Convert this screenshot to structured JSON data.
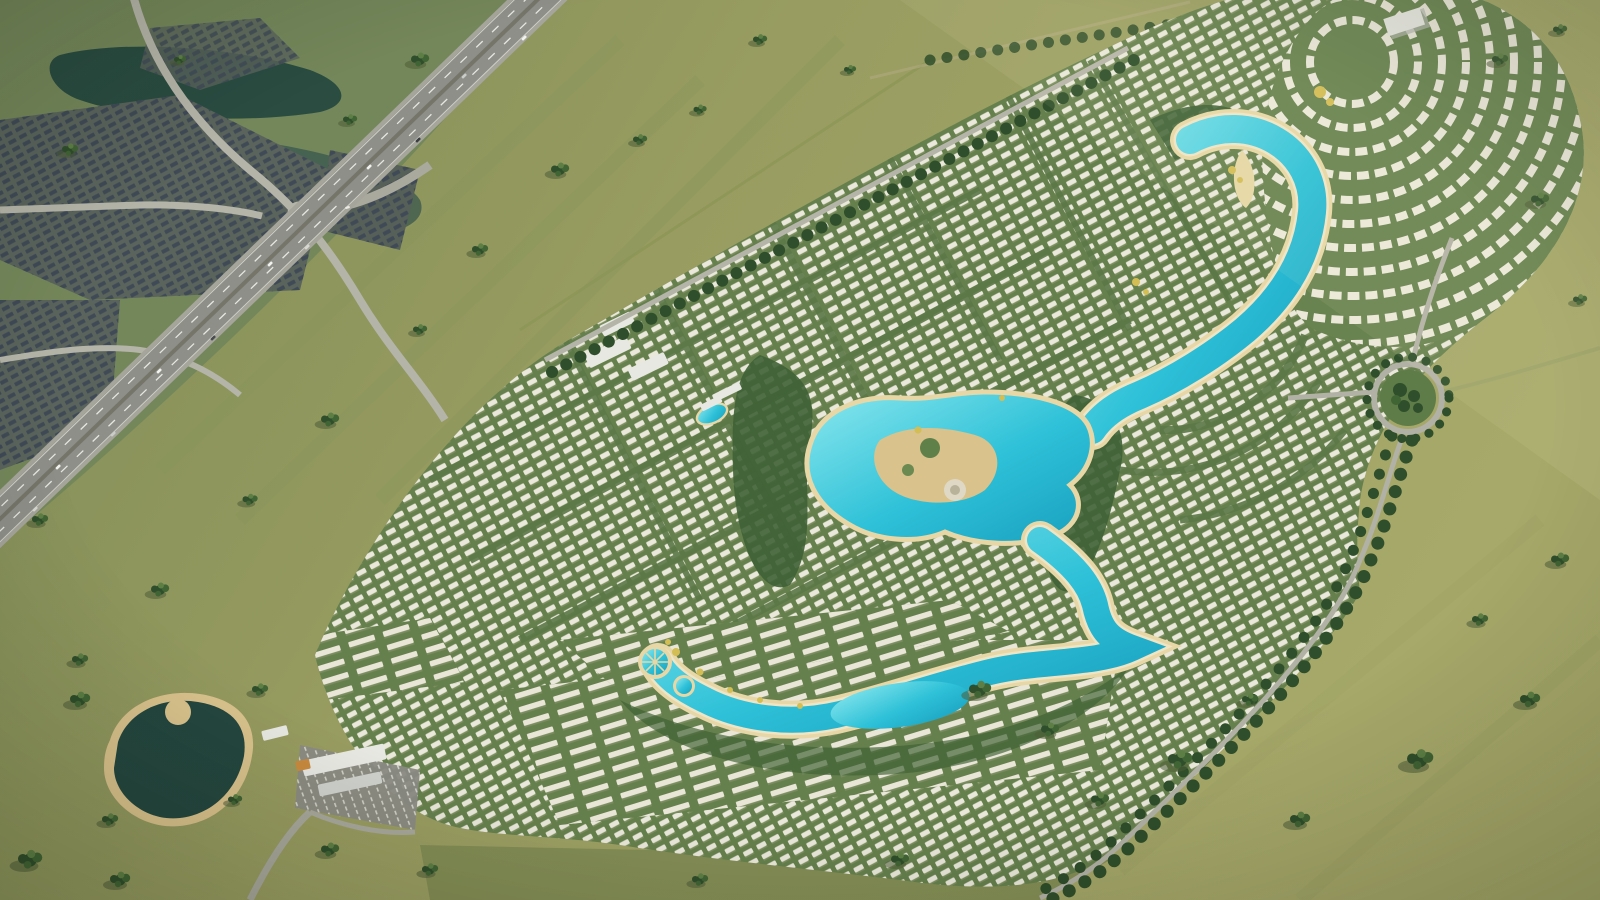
{
  "image": {
    "kind": "aerial-masterplan-render",
    "width_px": 1600,
    "height_px": 900
  },
  "palette": {
    "grass_left": "#7e8c58",
    "grass_mid": "#989c60",
    "grass_right": "#a7a96a",
    "field_south": "#7f8a52",
    "dev_green": "#66804d",
    "street_green": "#5c7847",
    "tree_dark": "#2f4e2b",
    "tree_mid": "#416434",
    "tree_light": "#5d7f45",
    "shadow_olive": "#4e5c38",
    "palm_yellow": "#d3bd55",
    "lagoon_water": "#2ec1d8",
    "lagoon_deep": "#189fbe",
    "lagooon_shallow": "#8ce8ee",
    "beach_sand": "#e7d7a6",
    "foam_white": "#ffffff",
    "pond_dark": "#24473f",
    "pond_sand": "#d9c28c",
    "highway_asphalt": "#8e8f88",
    "highway_shoulder": "#a5a59b",
    "road_light": "#b5b4a8",
    "road_minor": "#a9a89c",
    "suburb_ground": "#5a645c",
    "suburb_roof": "#3f4a56",
    "villa_roof": "#edebde",
    "townhouse_roof": "#e9e6d8",
    "building_white": "#e7e8e2",
    "building_gray": "#c3c6c1",
    "parking_gray": "#8b8b84",
    "orange_canopy": "#c98a3e",
    "marsh_dark": "#33524b"
  },
  "scene": {
    "features": [
      "existing-suburb-top-left",
      "dark-pond-top-left",
      "highway-diagonal",
      "grass-median-band",
      "masterplan-community",
      "villa-grid-blocks",
      "arc-villa-cluster-top-right",
      "townhouse-rows-south",
      "central-lagoon-with-islands",
      "right-lagoon-channel",
      "south-beach-lagoon",
      "round-pool-decks",
      "amenity-pool-small",
      "roundabout-park-right",
      "perimeter-tree-road",
      "sales-center-with-parking",
      "dark-park-pond-bottom-left",
      "warehouse-top-right",
      "tree-clusters-fields"
    ]
  }
}
